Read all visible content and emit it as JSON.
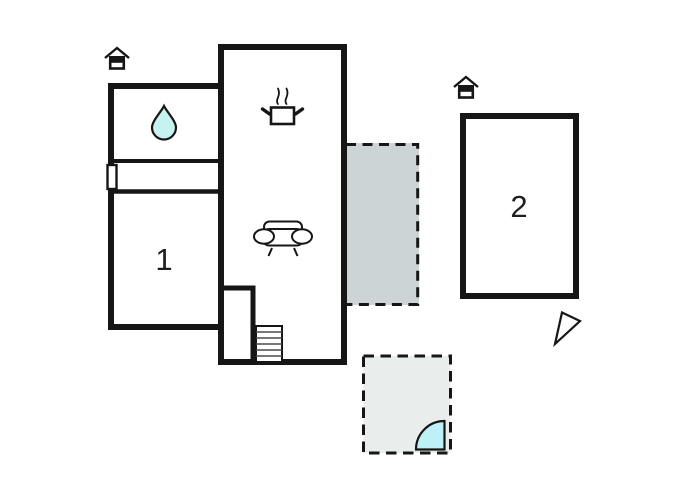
{
  "floor_plan": {
    "title": "holiday-home-floor-plan",
    "rooms": [
      {
        "id": "room-1",
        "label": "1"
      },
      {
        "id": "room-2",
        "label": "2"
      }
    ],
    "features": {
      "bathroom_symbol": "water-drop",
      "kitchen_symbol": "cooking-pot-with-steam",
      "living_symbol": "sofa",
      "stairs_steps": 6,
      "entrance_markers": 2,
      "orientation_marker": "north-arrow",
      "outdoor_areas": [
        {
          "id": "terrace",
          "style": "dashed-outline",
          "attached_to": "main-building"
        },
        {
          "id": "patio",
          "style": "dashed-outline",
          "detail": "door-swing-arc"
        }
      ]
    },
    "colors": {
      "wall": "#161616",
      "background": "#ffffff",
      "terrace_fill": "#cdd4d5",
      "patio_fill": "#e9edec",
      "water_drop_fill": "#c6f3f0",
      "door_arc_fill": "#bdf1f7",
      "step_line": "#4a4a4a"
    }
  }
}
